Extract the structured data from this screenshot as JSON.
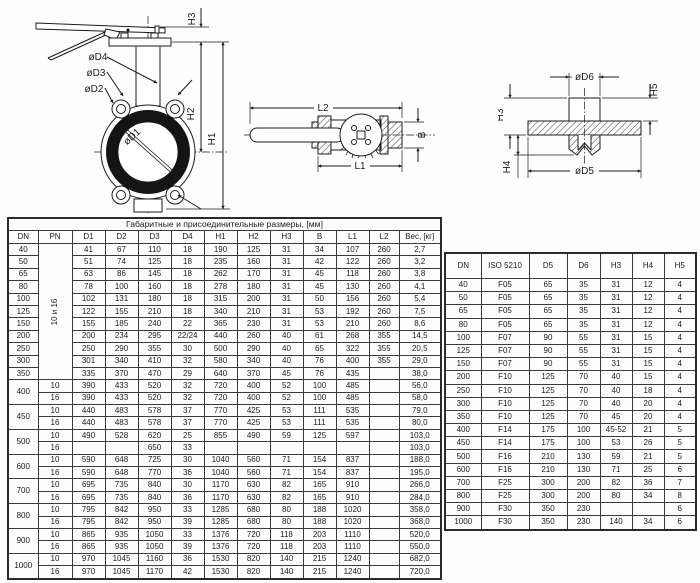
{
  "main_table": {
    "title": "Габаритные и присоединительные размеры, [мм]",
    "columns": [
      "DN",
      "PN",
      "D1",
      "D2",
      "D3",
      "D4",
      "H1",
      "H2",
      "H3",
      "B",
      "L1",
      "L2",
      "Вес, [кг]"
    ],
    "rows": [
      {
        "dn": "40",
        "pn": "10 и 16",
        "pn_span": 11,
        "pn_vertical": true,
        "c": [
          "41",
          "67",
          "110",
          "18",
          "190",
          "125",
          "31",
          "34",
          "107",
          "260",
          "2,7"
        ]
      },
      {
        "dn": "50",
        "c": [
          "51",
          "74",
          "125",
          "18",
          "235",
          "160",
          "31",
          "42",
          "122",
          "260",
          "3,2"
        ]
      },
      {
        "dn": "65",
        "c": [
          "63",
          "86",
          "145",
          "18",
          "262",
          "170",
          "31",
          "45",
          "118",
          "260",
          "3,8"
        ]
      },
      {
        "dn": "80",
        "c": [
          "78",
          "100",
          "160",
          "18",
          "278",
          "180",
          "31",
          "45",
          "130",
          "260",
          "4,1"
        ]
      },
      {
        "dn": "100",
        "c": [
          "102",
          "131",
          "180",
          "18",
          "315",
          "200",
          "31",
          "50",
          "156",
          "260",
          "5,4"
        ]
      },
      {
        "dn": "125",
        "c": [
          "122",
          "155",
          "210",
          "18",
          "340",
          "210",
          "31",
          "53",
          "192",
          "260",
          "7,5"
        ]
      },
      {
        "dn": "150",
        "c": [
          "155",
          "185",
          "240",
          "22",
          "365",
          "230",
          "31",
          "53",
          "210",
          "260",
          "8,6"
        ]
      },
      {
        "dn": "200",
        "c": [
          "200",
          "234",
          "295",
          "22/24",
          "440",
          "260",
          "40",
          "61",
          "268",
          "355",
          "14,5"
        ]
      },
      {
        "dn": "250",
        "c": [
          "250",
          "290",
          "355",
          "30",
          "500",
          "290",
          "40",
          "65",
          "322",
          "355",
          "20,5"
        ]
      },
      {
        "dn": "300",
        "c": [
          "301",
          "340",
          "410",
          "32",
          "580",
          "340",
          "40",
          "76",
          "400",
          "355",
          "29,0"
        ]
      },
      {
        "dn": "350",
        "c": [
          "335",
          "370",
          "470",
          "29",
          "640",
          "370",
          "45",
          "76",
          "435",
          "",
          "38,0"
        ]
      },
      {
        "dn": "400",
        "dn_span": 2,
        "pn": "10",
        "c": [
          "390",
          "433",
          "520",
          "32",
          "720",
          "400",
          "52",
          "100",
          "485",
          "",
          "56,0"
        ]
      },
      {
        "pn": "16",
        "c": [
          "390",
          "433",
          "520",
          "32",
          "720",
          "400",
          "52",
          "100",
          "485",
          "",
          "58,0"
        ]
      },
      {
        "dn": "450",
        "dn_span": 2,
        "pn": "10",
        "c": [
          "440",
          "483",
          "578",
          "37",
          "770",
          "425",
          "53",
          "111",
          "535",
          "",
          "79,0"
        ]
      },
      {
        "pn": "16",
        "c": [
          "440",
          "483",
          "578",
          "37",
          "770",
          "425",
          "53",
          "111",
          "535",
          "",
          "80,0"
        ]
      },
      {
        "dn": "500",
        "dn_span": 2,
        "pn": "10",
        "c": [
          "490",
          "528",
          "620",
          "25",
          "855",
          "490",
          "59",
          "125",
          "597",
          "",
          "103,0"
        ]
      },
      {
        "pn": "16",
        "c": [
          "",
          "",
          "650",
          "33",
          "",
          "",
          "",
          "",
          "",
          "",
          "103,0"
        ]
      },
      {
        "dn": "600",
        "dn_span": 2,
        "pn": "10",
        "c": [
          "590",
          "648",
          "725",
          "30",
          "1040",
          "560",
          "71",
          "154",
          "837",
          "",
          "188,0"
        ]
      },
      {
        "pn": "16",
        "c": [
          "590",
          "648",
          "770",
          "36",
          "1040",
          "560",
          "71",
          "154",
          "837",
          "",
          "195,0"
        ]
      },
      {
        "dn": "700",
        "dn_span": 2,
        "pn": "10",
        "c": [
          "695",
          "735",
          "840",
          "30",
          "1170",
          "630",
          "82",
          "165",
          "910",
          "",
          "266,0"
        ]
      },
      {
        "pn": "16",
        "c": [
          "695",
          "735",
          "840",
          "36",
          "1170",
          "630",
          "82",
          "165",
          "910",
          "",
          "284,0"
        ]
      },
      {
        "dn": "800",
        "dn_span": 2,
        "pn": "10",
        "c": [
          "795",
          "842",
          "950",
          "33",
          "1285",
          "680",
          "80",
          "188",
          "1020",
          "",
          "358,0"
        ]
      },
      {
        "pn": "16",
        "c": [
          "795",
          "842",
          "950",
          "39",
          "1285",
          "680",
          "80",
          "188",
          "1020",
          "",
          "368,0"
        ]
      },
      {
        "dn": "900",
        "dn_span": 2,
        "pn": "10",
        "c": [
          "865",
          "935",
          "1050",
          "33",
          "1376",
          "720",
          "118",
          "203",
          "1110",
          "",
          "520,0"
        ]
      },
      {
        "pn": "16",
        "c": [
          "865",
          "935",
          "1050",
          "39",
          "1376",
          "720",
          "118",
          "203",
          "1110",
          "",
          "550,0"
        ]
      },
      {
        "dn": "1000",
        "dn_span": 2,
        "pn": "10",
        "c": [
          "970",
          "1045",
          "1160",
          "36",
          "1530",
          "820",
          "140",
          "215",
          "1240",
          "",
          "682,0"
        ]
      },
      {
        "pn": "16",
        "c": [
          "970",
          "1045",
          "1170",
          "42",
          "1530",
          "820",
          "140",
          "215",
          "1240",
          "",
          "720,0"
        ]
      }
    ]
  },
  "iso_table": {
    "columns": [
      "DN",
      "ISO 5210",
      "D5",
      "D6",
      "H3",
      "H4",
      "H5"
    ],
    "rows": [
      [
        "40",
        "F05",
        "65",
        "35",
        "31",
        "12",
        "4"
      ],
      [
        "50",
        "F05",
        "65",
        "35",
        "31",
        "12",
        "4"
      ],
      [
        "65",
        "F05",
        "65",
        "35",
        "31",
        "12",
        "4"
      ],
      [
        "80",
        "F05",
        "65",
        "35",
        "31",
        "12",
        "4"
      ],
      [
        "100",
        "F07",
        "90",
        "55",
        "31",
        "15",
        "4"
      ],
      [
        "125",
        "F07",
        "90",
        "55",
        "31",
        "15",
        "4"
      ],
      [
        "150",
        "F07",
        "90",
        "55",
        "31",
        "15",
        "4"
      ],
      [
        "200",
        "F10",
        "125",
        "70",
        "40",
        "15",
        "4"
      ],
      [
        "250",
        "F10",
        "125",
        "70",
        "40",
        "18",
        "4"
      ],
      [
        "300",
        "F10",
        "125",
        "70",
        "40",
        "20",
        "4"
      ],
      [
        "350",
        "F10",
        "125",
        "70",
        "45",
        "20",
        "4"
      ],
      [
        "400",
        "F14",
        "175",
        "100",
        "45-52",
        "21",
        "5"
      ],
      [
        "450",
        "F14",
        "175",
        "100",
        "53",
        "26",
        "5"
      ],
      [
        "500",
        "F16",
        "210",
        "130",
        "59",
        "21",
        "5"
      ],
      [
        "600",
        "F16",
        "210",
        "130",
        "71",
        "25",
        "6"
      ],
      [
        "700",
        "F25",
        "300",
        "200",
        "82",
        "36",
        "7"
      ],
      [
        "800",
        "F25",
        "300",
        "200",
        "80",
        "34",
        "8"
      ],
      [
        "900",
        "F30",
        "350",
        "230",
        "",
        "",
        "6"
      ],
      [
        "1000",
        "F30",
        "350",
        "230",
        "140",
        "34",
        "6"
      ]
    ]
  },
  "drawings": {
    "front_view": {
      "d4": "øD4",
      "d3": "øD3",
      "d2": "øD2",
      "d1": "øD1",
      "h3": "H3",
      "h2": "H2",
      "h1": "H1"
    },
    "top_view": {
      "l2": "L2",
      "l1": "L1",
      "b": "B"
    },
    "flange_view": {
      "d6": "øD6",
      "d5": "øD5",
      "h3": "H3",
      "h4": "H4",
      "h5": "H5"
    }
  },
  "colors": {
    "ink": "#1b1b1b",
    "border": "#3a3a3a",
    "ring_fill": "#141414"
  }
}
